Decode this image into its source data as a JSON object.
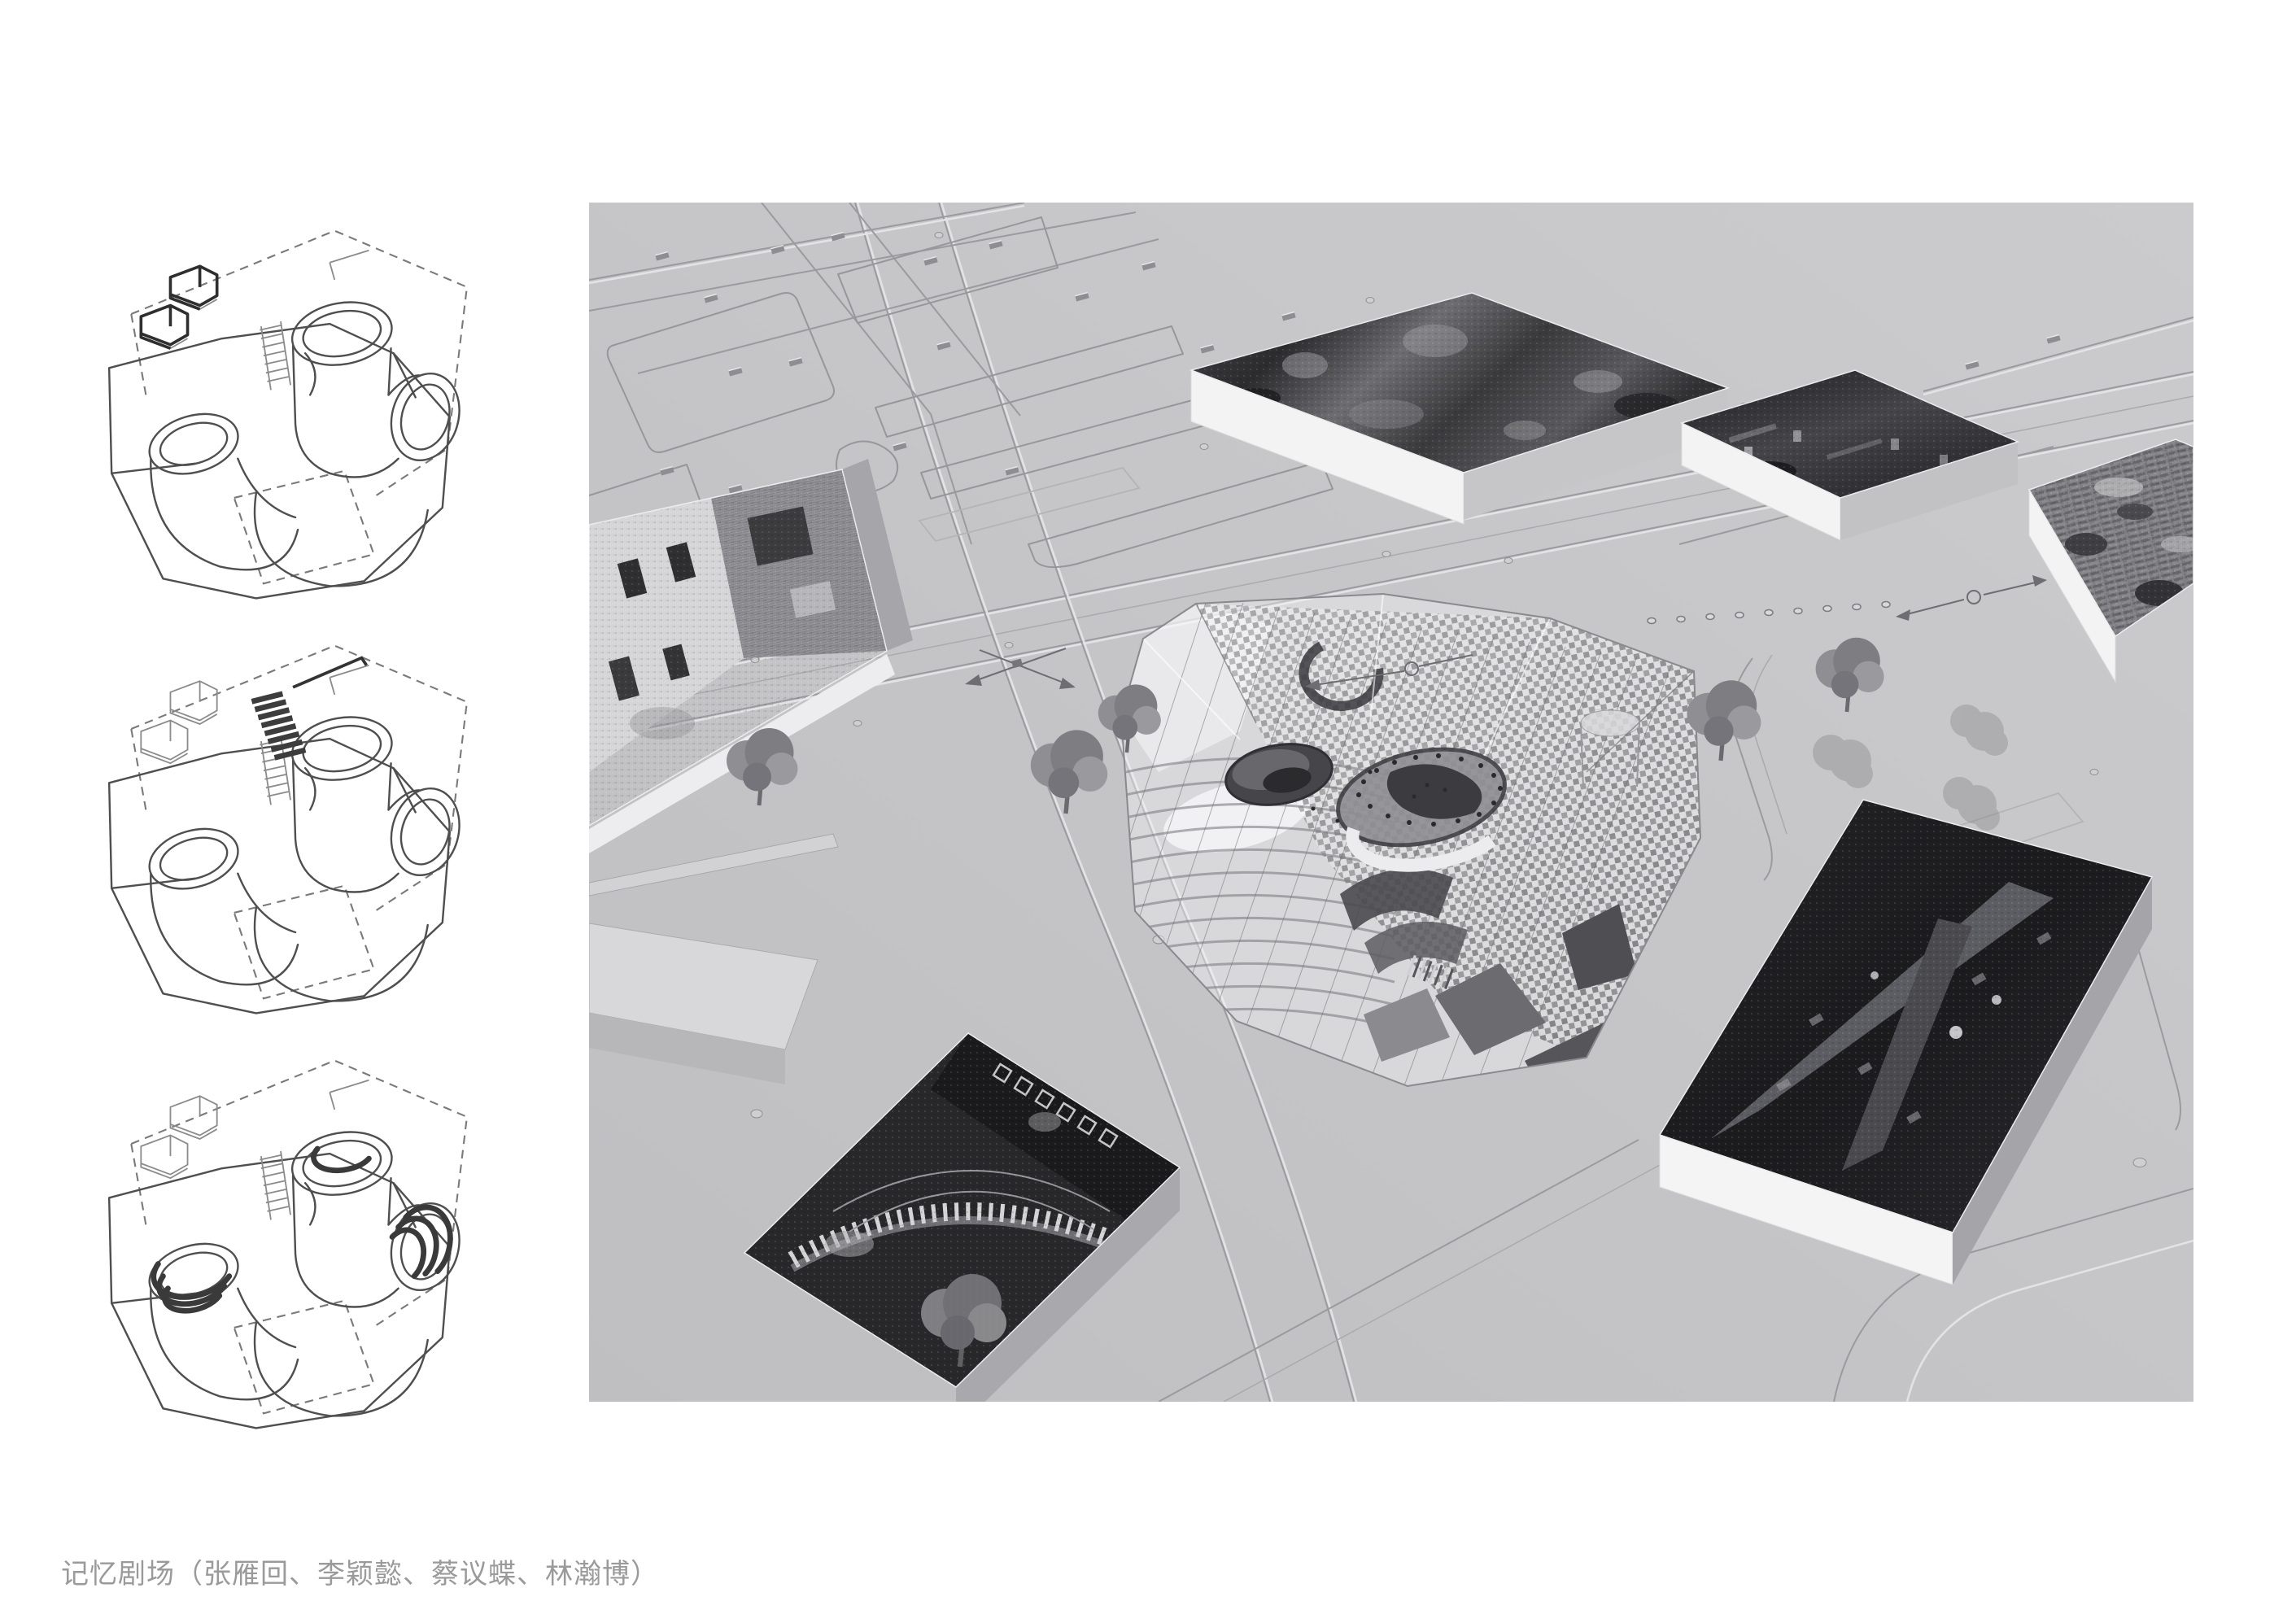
{
  "page": {
    "background": "#ffffff"
  },
  "caption": {
    "text": "记忆剧场（张雁回、李颖懿、蔡议蝶、林瀚博）",
    "color": "#9a9a9a"
  },
  "colors": {
    "ground": "#c6c6c8",
    "ground_shade": "#bfbfc2",
    "road_line": "#9b9b9f",
    "road_highlight": "#e3e3e5",
    "box_face_light": "#f3f3f4",
    "box_face_shadow": "#a9a9ad",
    "photo_dark": "#1e1e21",
    "canopy_checker": "#323236",
    "sketch_line": "#4f4f4f",
    "sketch_dash": "#7a7a7a",
    "tree": "#7e7e82",
    "caption_text": "#9a9a9a"
  },
  "figures": {
    "sketches": [
      {
        "name": "axon-sketch-massing-1"
      },
      {
        "name": "axon-sketch-massing-2"
      },
      {
        "name": "axon-sketch-massing-3"
      }
    ],
    "render": {
      "name": "site-axonometric-render"
    }
  }
}
